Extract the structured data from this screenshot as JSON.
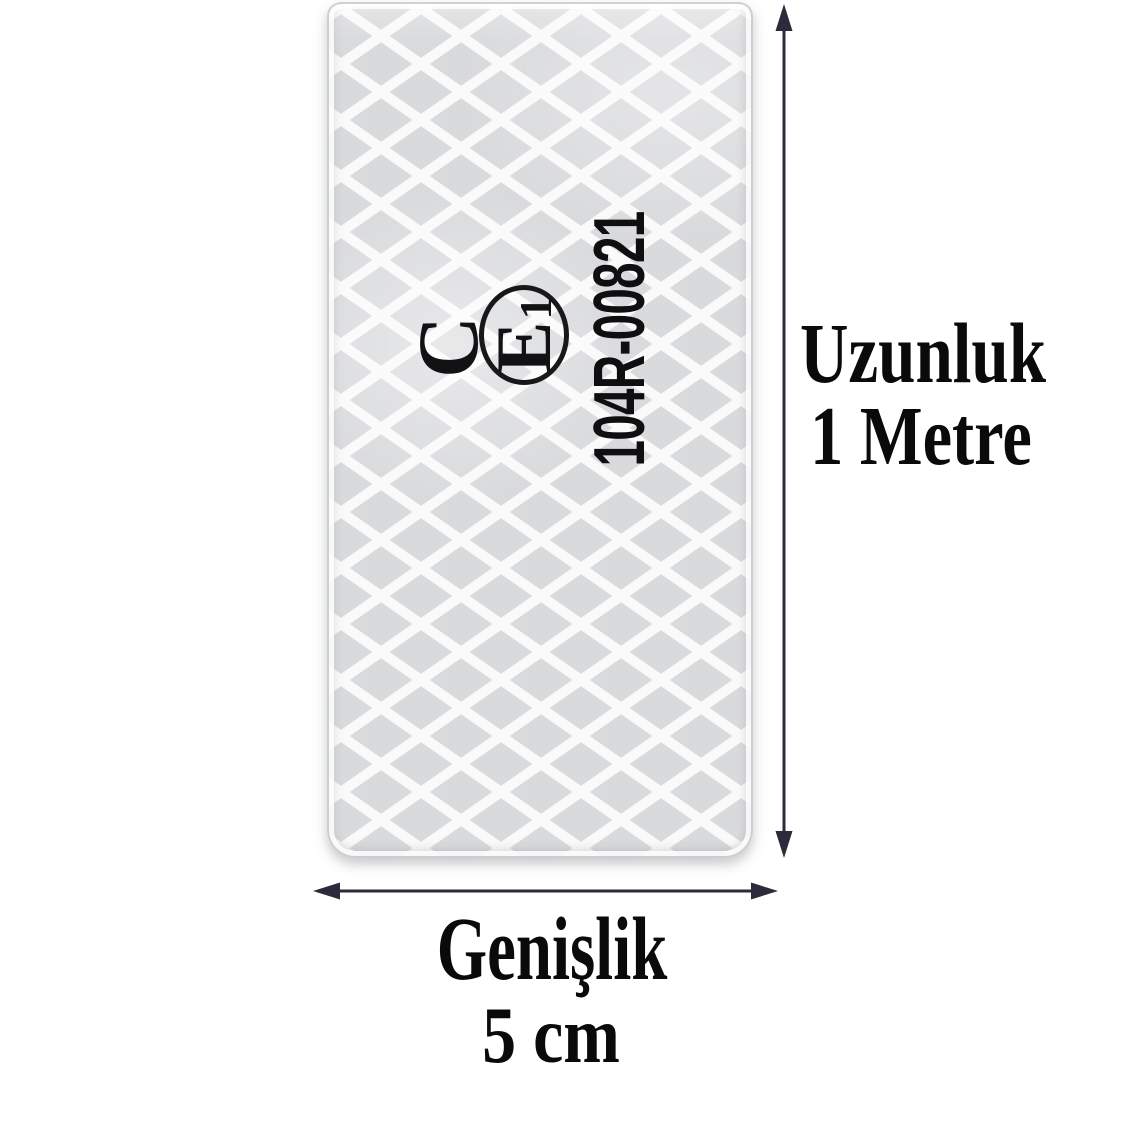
{
  "tape": {
    "marking": {
      "letter": "C",
      "e_mark_letter": "E",
      "e_mark_number": "1",
      "approval_code": "104R-00821"
    }
  },
  "dimensions": {
    "length": {
      "title": "Uzunluk",
      "value": "1 Metre"
    },
    "width": {
      "title": "Genişlik",
      "value": "5 cm"
    }
  },
  "colors": {
    "arrow": "#2b2b3b",
    "label_text": "#0a0a0a",
    "marking_text": "#121214",
    "tape_fill": "#d9dadc",
    "lattice": "#fafafa"
  }
}
